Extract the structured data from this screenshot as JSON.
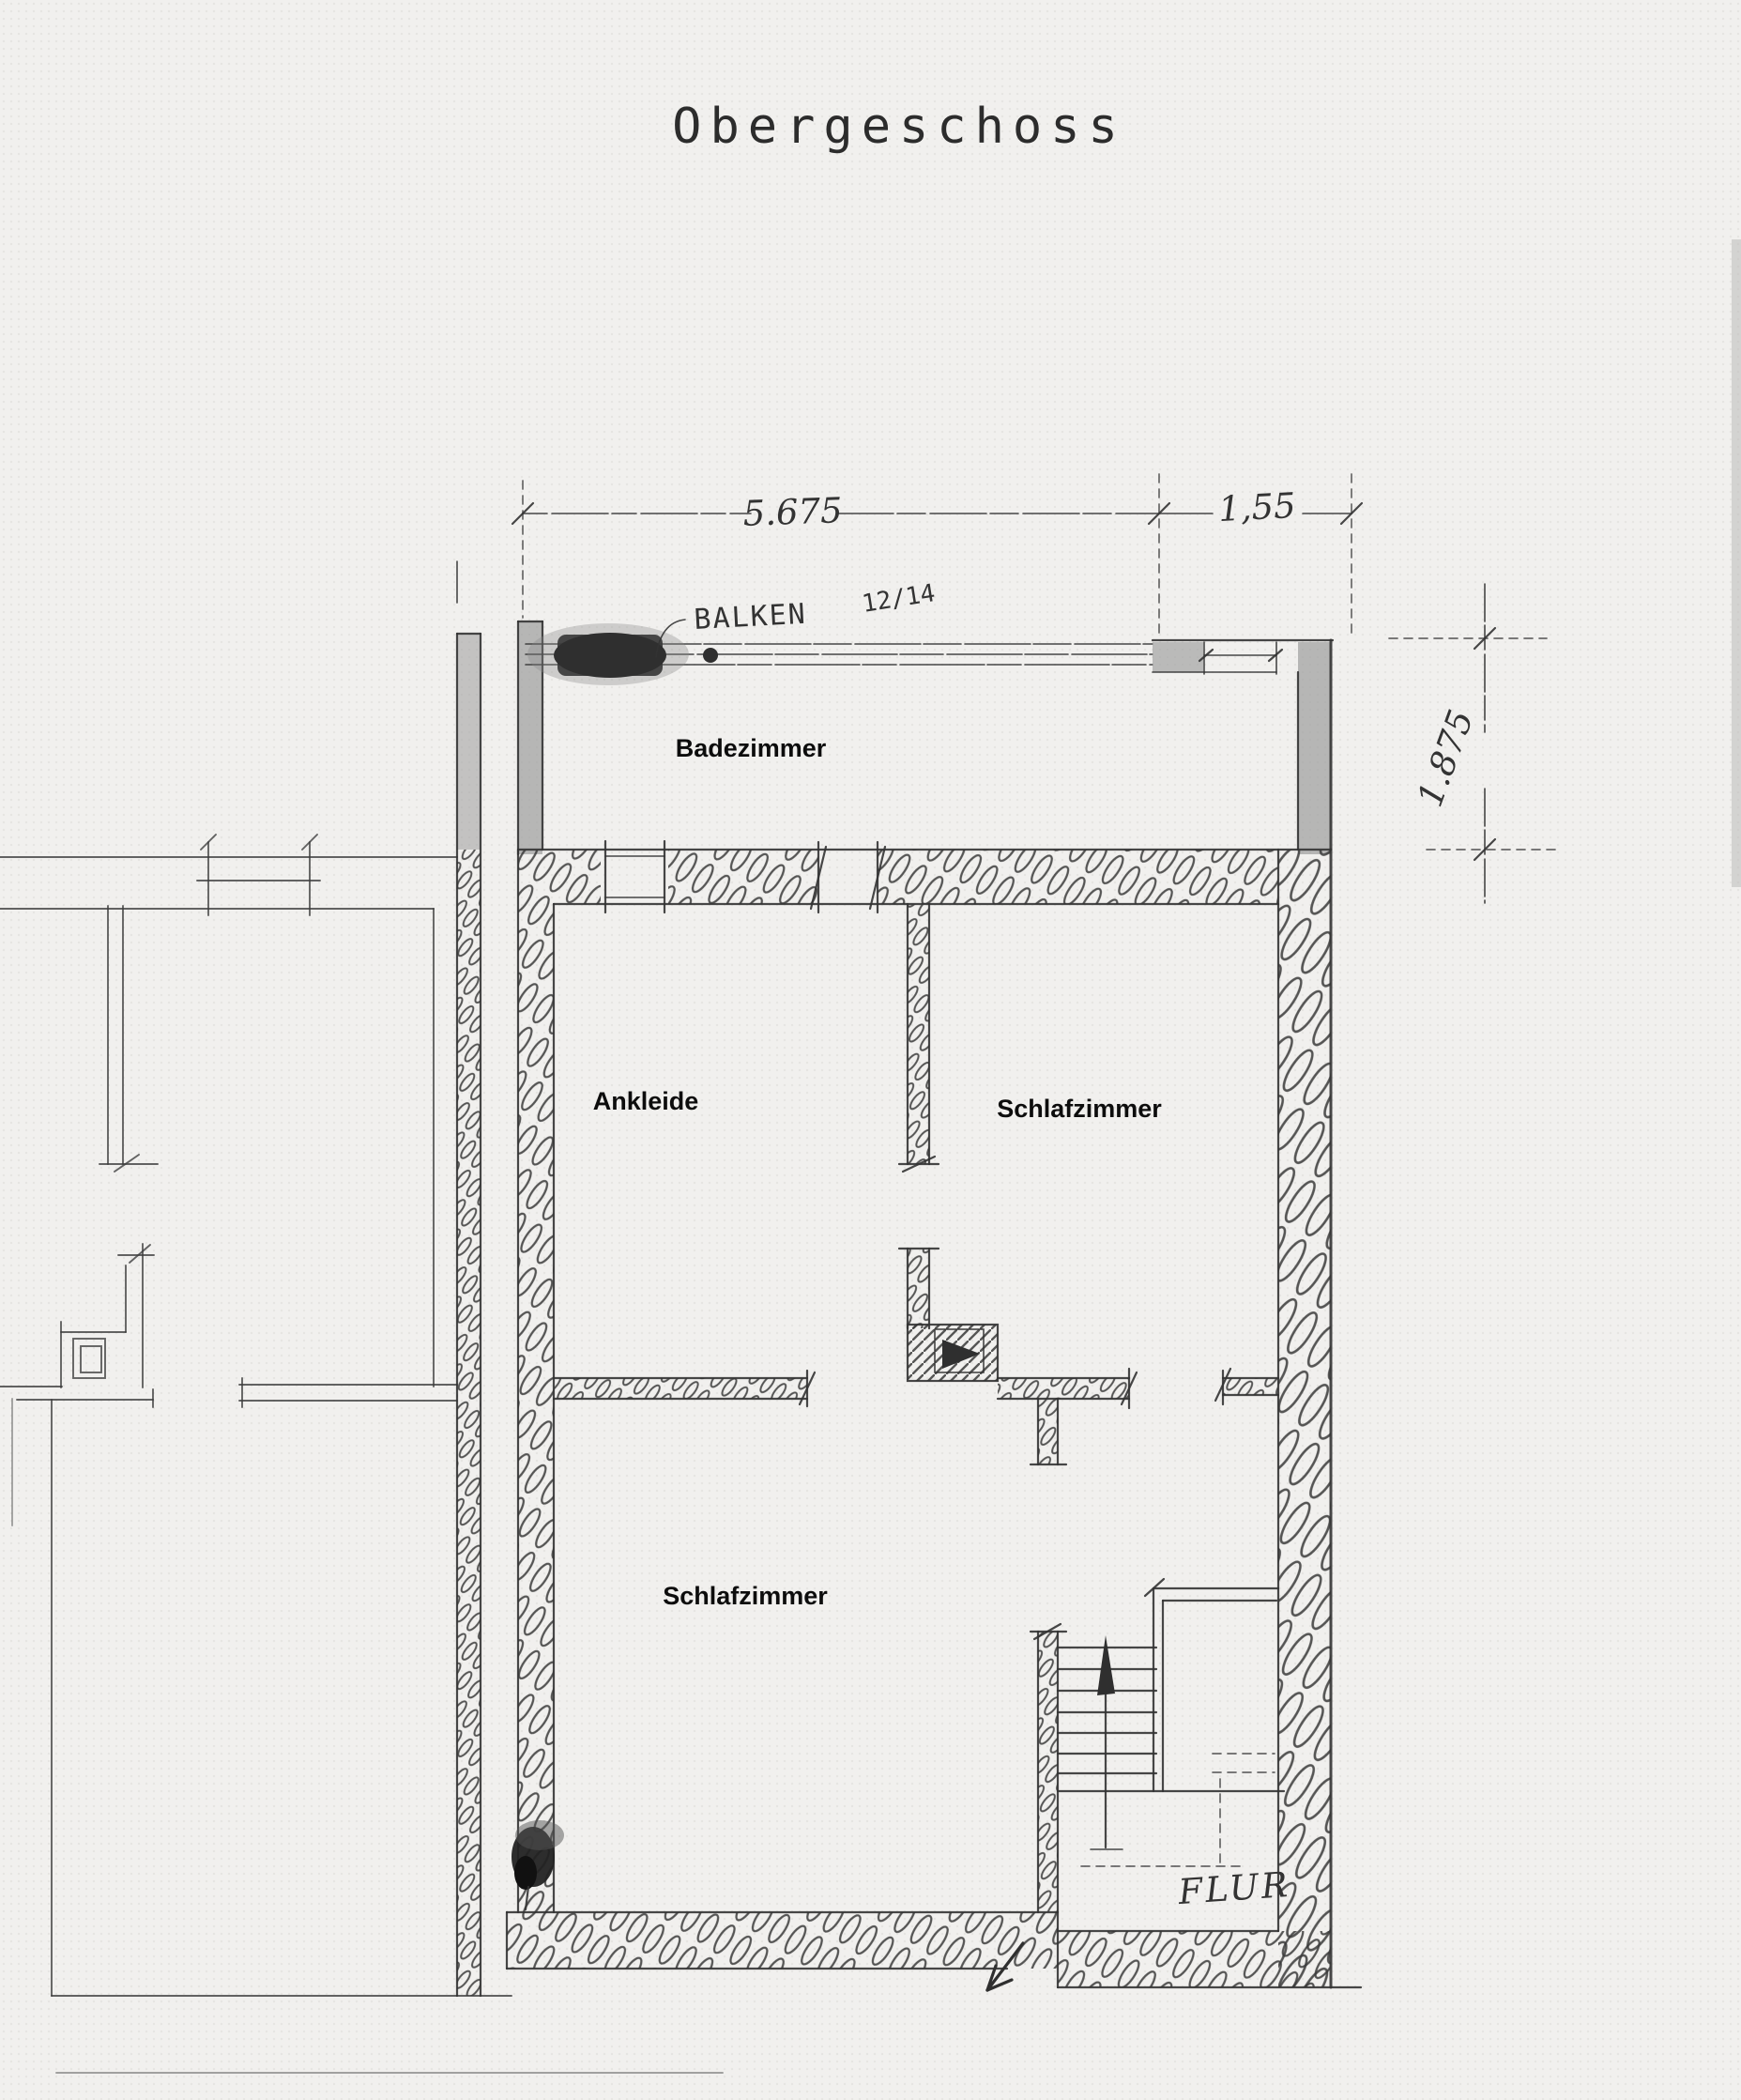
{
  "page": {
    "title": "Obergeschoss"
  },
  "rooms": {
    "badezimmer": "Badezimmer",
    "ankleide": "Ankleide",
    "schlafzimmer_right": "Schlafzimmer",
    "schlafzimmer_lower": "Schlafzimmer",
    "flur": "FLUR"
  },
  "dimensions": {
    "top_width": "5.675",
    "top_width_right": "1,55",
    "right_depth": "1.875"
  },
  "annotations": {
    "beam_label": "BALKEN",
    "beam_size": "12/14"
  },
  "colors": {
    "paper": "#f1f0ee",
    "pencil": "#333333",
    "grey_wall": "#9d9d9d",
    "dark_blob": "#2f2f2f"
  }
}
